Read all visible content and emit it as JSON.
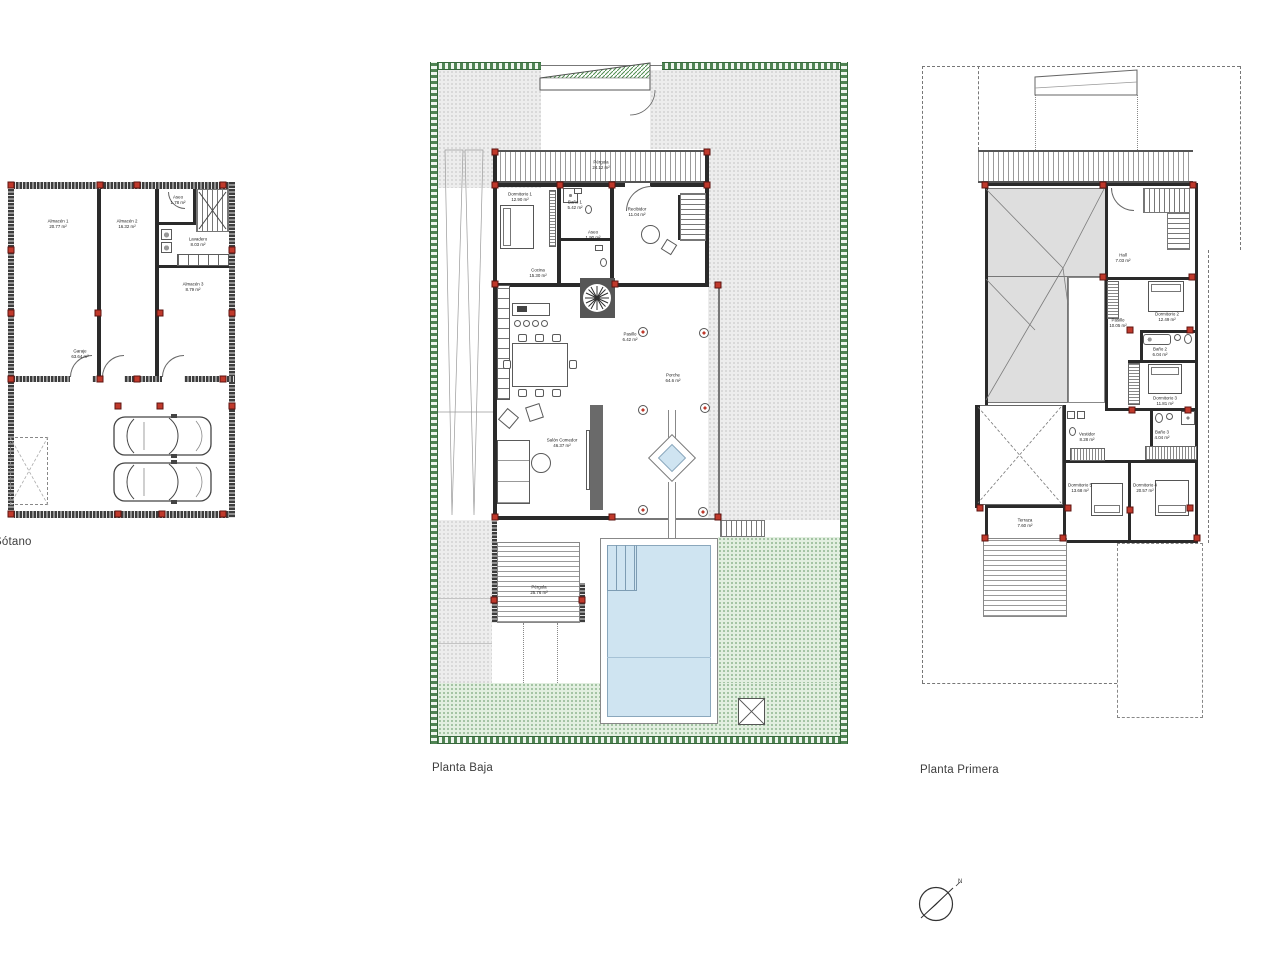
{
  "canvas": {
    "width": 1280,
    "height": 960,
    "background": "#ffffff"
  },
  "colors": {
    "wall": "#2a2a2a",
    "column_marker": "#c0392b",
    "hedge": "#35663a",
    "lawn": "#e2efe0",
    "paving": "#ededed",
    "water": "#cfe4f1",
    "roof": "#dedede"
  },
  "plans": {
    "sotano": {
      "label": "Sótano",
      "rooms": {
        "almacen1": {
          "name": "Almacén 1",
          "area": "20.77 m²"
        },
        "almacen2": {
          "name": "Almacén 2",
          "area": "16.32 m²"
        },
        "aseo": {
          "name": "Aseo",
          "area": "1.78 m²"
        },
        "lavadero": {
          "name": "Lavadero",
          "area": "8.03 m²"
        },
        "almacen3": {
          "name": "Almacén 3",
          "area": "8.79 m²"
        },
        "garaje": {
          "name": "Garaje",
          "area": "63.64 m²"
        }
      }
    },
    "planta_baja": {
      "label": "Planta Baja",
      "rooms": {
        "pergola_norte": {
          "name": "Pérgola",
          "area": "24.12 m²"
        },
        "dormitorio1": {
          "name": "Dormitorio 1",
          "area": "12.90 m²"
        },
        "bano1": {
          "name": "Baño 1",
          "area": "5.42 m²"
        },
        "aseo": {
          "name": "Aseo",
          "area": "1.90 m²"
        },
        "recibidor": {
          "name": "Recibidor",
          "area": "11.04 m²"
        },
        "pasillo": {
          "name": "Pasillo",
          "area": "6.42 m²"
        },
        "cocina": {
          "name": "Cocina",
          "area": "15.30 m²"
        },
        "salon_comedor": {
          "name": "Salón Comedor",
          "area": "46.37 m²"
        },
        "porche": {
          "name": "Porche",
          "area": "64.6 m²"
        },
        "pergola_sur": {
          "name": "Pérgola",
          "area": "25.76 m²"
        }
      }
    },
    "planta_primera": {
      "label": "Planta Primera",
      "rooms": {
        "hall": {
          "name": "Hall",
          "area": "7.03 m²"
        },
        "pasillo": {
          "name": "Pasillo",
          "area": "10.05 m²"
        },
        "dormitorio2": {
          "name": "Dormitorio 2",
          "area": "12.49 m²"
        },
        "bano2": {
          "name": "Baño 2",
          "area": "6.04 m²"
        },
        "dormitorio3": {
          "name": "Dormitorio 3",
          "area": "11.81 m²"
        },
        "bano3": {
          "name": "Baño 3",
          "area": "4.04 m²"
        },
        "vestidor": {
          "name": "Vestidor",
          "area": "8.28 m²"
        },
        "dormitorio5": {
          "name": "Dormitorio 5",
          "area": "13.68 m²"
        },
        "dormitorio4": {
          "name": "Dormitorio 4",
          "area": "20.57 m²"
        },
        "terraza": {
          "name": "Terraza",
          "area": "7.60 m²"
        }
      }
    }
  },
  "compass": {
    "label": "N"
  }
}
